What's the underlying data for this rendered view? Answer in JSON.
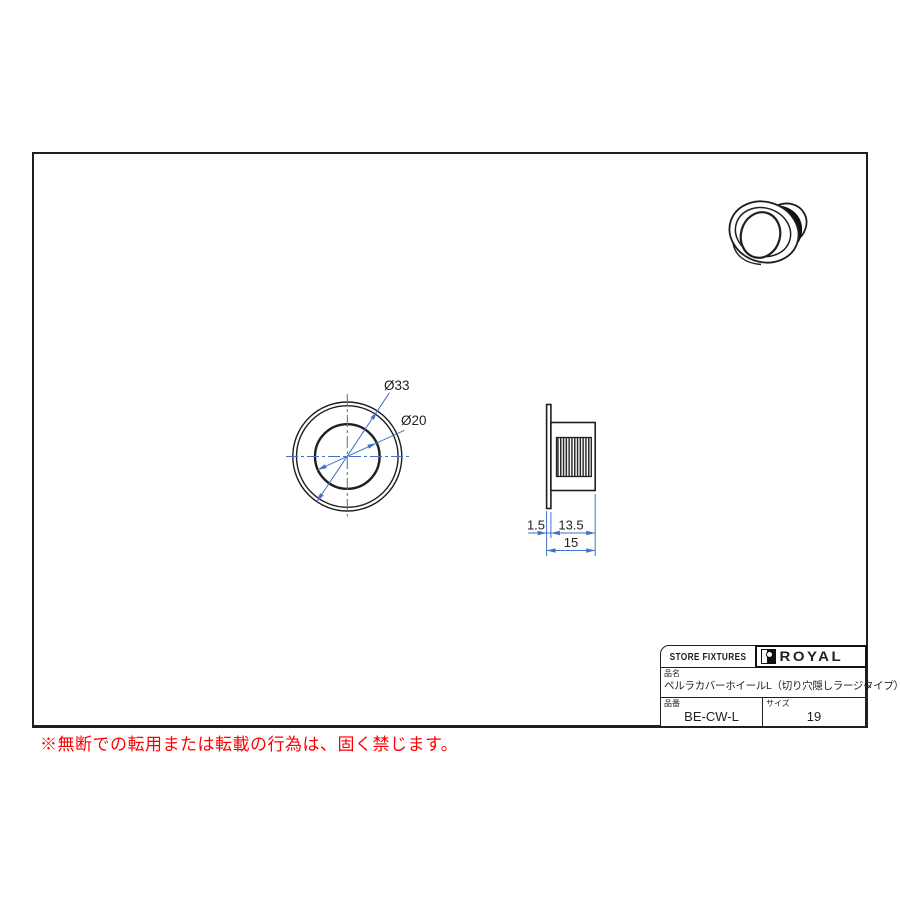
{
  "colors": {
    "line": "#1f1f1f",
    "dimension": "#4472c4",
    "warning": "#ff0000"
  },
  "drawing": {
    "front_view": {
      "outer_dia_label": "Ø33",
      "inner_dia_label": "Ø20"
    },
    "side_view": {
      "flange_thickness": "1.5",
      "body_depth": "13.5",
      "total_depth": "15"
    }
  },
  "title_block": {
    "store_label": "STORE FIXTURES",
    "brand": "ROYAL",
    "product_name_label": "品名",
    "product_name": "ペルラカバーホイールL（切り穴隠しラージタイプ）",
    "product_code_label": "品番",
    "product_code": "BE-CW-L",
    "size_label": "サイズ",
    "size_value": "19"
  },
  "footer": {
    "warning": "※無断での転用または転載の行為は、固く禁じます。"
  }
}
